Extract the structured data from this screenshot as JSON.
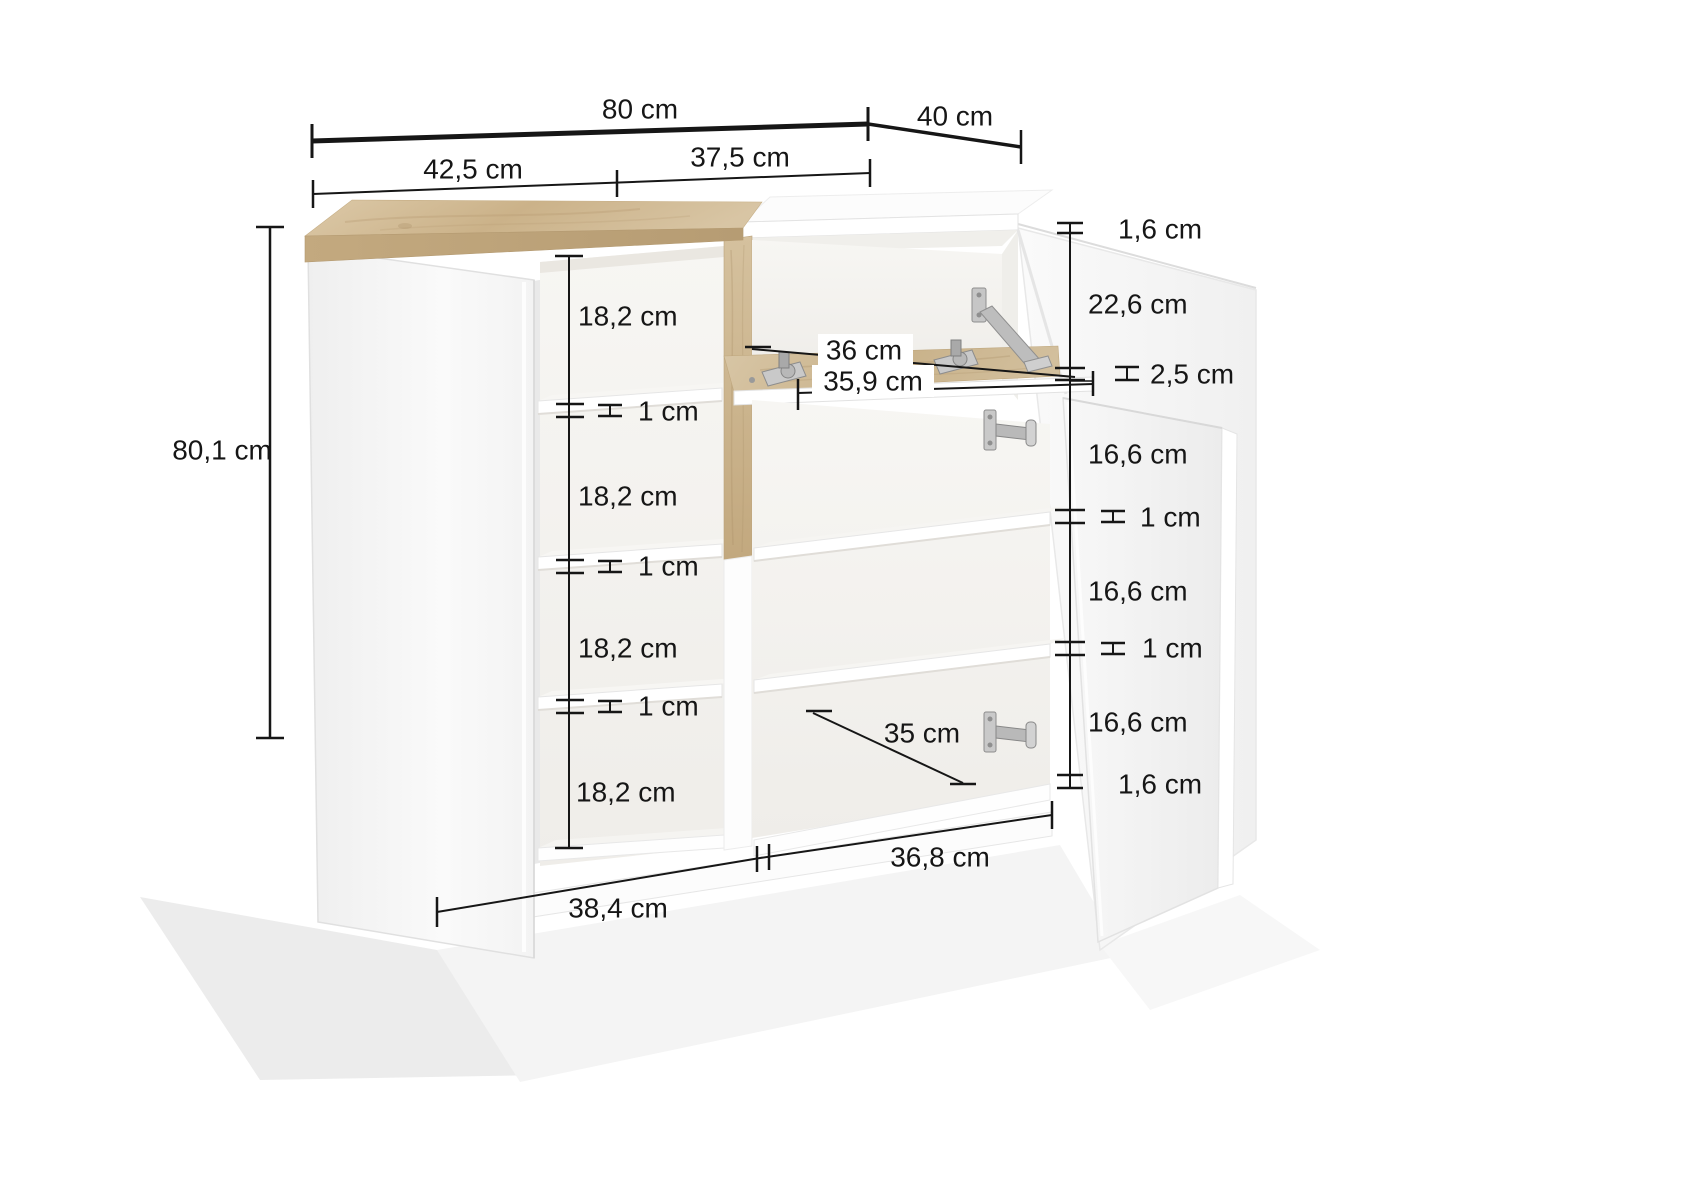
{
  "drawing": {
    "type": "furniture-dimension-diagram",
    "subject": "sideboard with two doors and drop-down flap",
    "units": "cm",
    "palette": {
      "dimension_line": "#161616",
      "wood_light": "#d8c6a6",
      "wood_dark": "#b69c73",
      "panel_white": "#ffffff",
      "floor_shadow": "#ececec"
    },
    "dims": {
      "total_width": "80 cm",
      "depth": "40 cm",
      "left_section_width": "42,5 cm",
      "right_section_width": "37,5 cm",
      "height": "80,1 cm",
      "left_gaps": [
        "18,2 cm",
        "18,2 cm",
        "18,2 cm",
        "18,2 cm"
      ],
      "left_shelf_th": [
        "1 cm",
        "1 cm",
        "1 cm"
      ],
      "top_th": "1,6 cm",
      "flap_opening": "22,6 cm",
      "flap_th": "2,5 cm",
      "right_gaps": [
        "16,6 cm",
        "16,6 cm",
        "16,6 cm"
      ],
      "right_shelf_th": [
        "1 cm",
        "1 cm"
      ],
      "bottom_th": "1,6 cm",
      "flap_depth": "36 cm",
      "flap_width": "35,9 cm",
      "interior_depth": "35 cm",
      "left_door_width": "38,4 cm",
      "right_door_width": "36,8 cm"
    }
  }
}
